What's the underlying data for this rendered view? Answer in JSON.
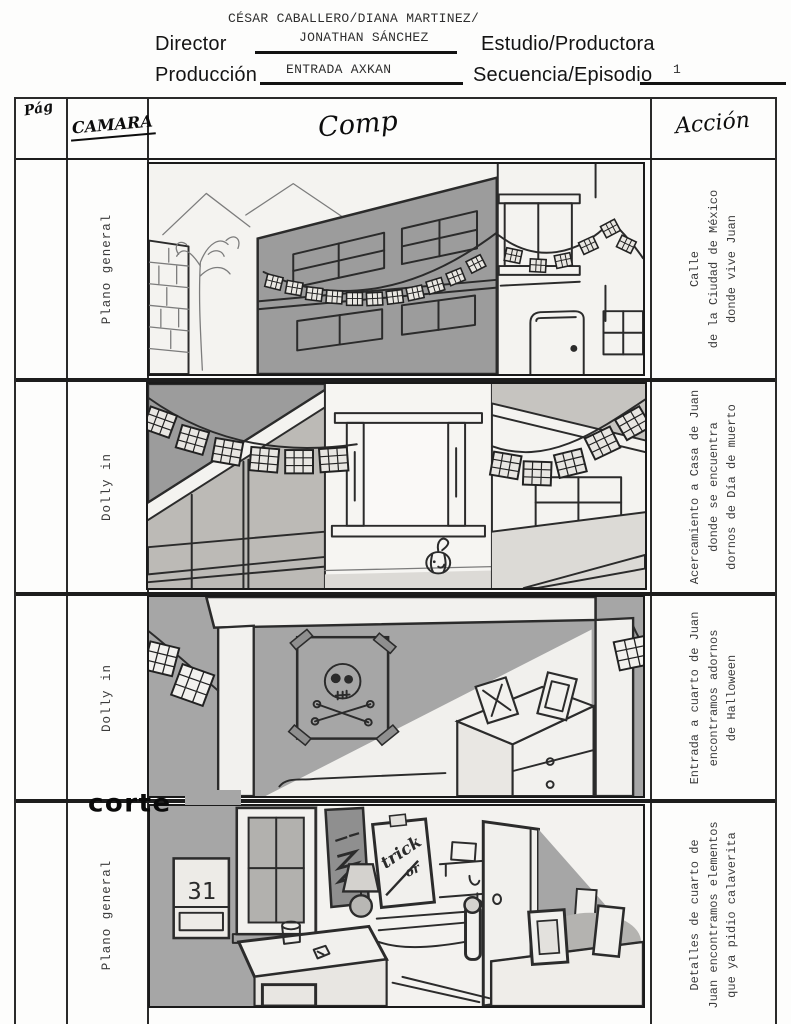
{
  "header": {
    "director_label": "Director",
    "director_value_line1": "CÉSAR CABALLERO/DIANA MARTINEZ/",
    "director_value_line2": "JONATHAN SÁNCHEZ",
    "estudio_label": "Estudio/Productora",
    "produccion_label": "Producción",
    "produccion_value": "ENTRADA AXKAN",
    "secuencia_label": "Secuencia/Episodio",
    "secuencia_value": "1"
  },
  "table": {
    "col_page": "Pág",
    "col_camera": "CAMARA",
    "col_frame": "Comp",
    "col_action": "Acción",
    "rows": [
      {
        "camera": "Plano general",
        "action_lines": [
          "Calle",
          "de la Ciudad de México",
          "donde vive Juan"
        ],
        "sketch": "calle-de-la-ciudad-de-mexico"
      },
      {
        "camera": "Dolly in",
        "action_lines": [
          "Acercamiento a Casa de Juan",
          "donde se encuentra",
          "dornos de Día de muerto"
        ],
        "sketch": "casa-de-juan-con-adornos"
      },
      {
        "camera": "Dolly in",
        "action_lines": [
          "Entrada a cuarto de Juan",
          "encontramos adornos",
          "de Halloween"
        ],
        "sketch": "entrada-cuarto-de-juan"
      },
      {
        "camera": "Plano general",
        "annotation": "corte",
        "action_lines": [
          "Detalles de cuarto de",
          "Juan encontramos elementos",
          "que ya pidio calaverita"
        ],
        "sketch": "detalles-cuarto-de-juan"
      }
    ]
  },
  "sketch_text": {
    "calendar_day": "31",
    "poster_line1": "trick",
    "poster_line2": "or"
  }
}
